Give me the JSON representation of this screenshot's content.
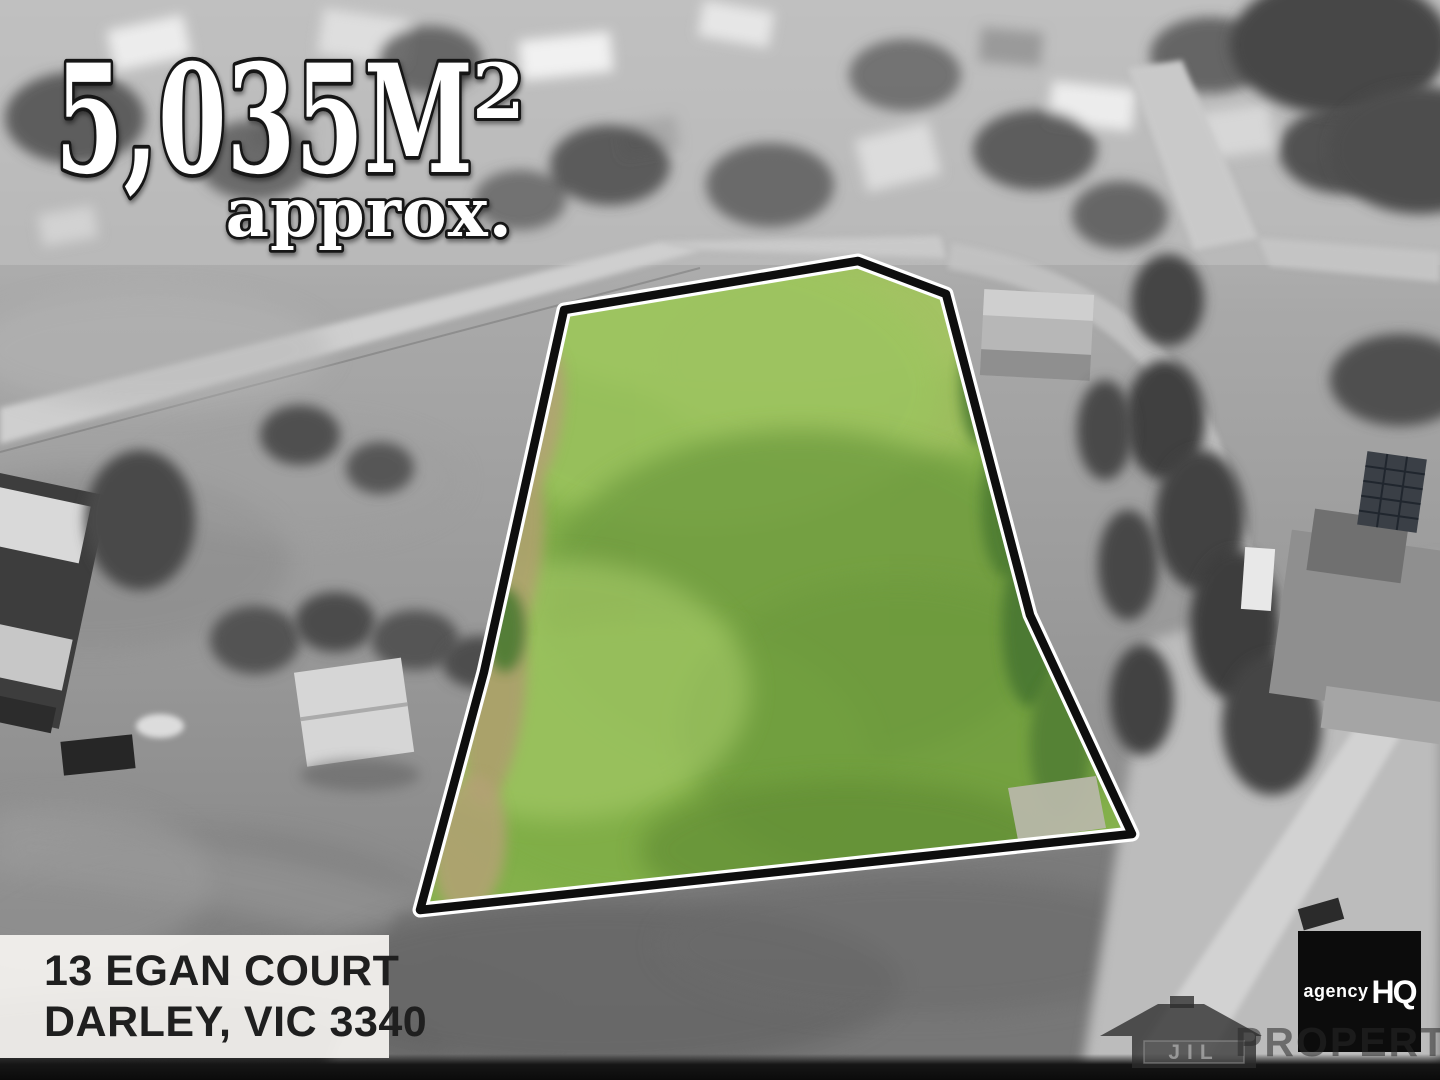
{
  "headline": {
    "area_value": "5,035M",
    "area_exponent": "2",
    "qualifier": "approx."
  },
  "address": {
    "line1": "13 EGAN COURT",
    "line2": "DARLEY, VIC 3340"
  },
  "branding": {
    "agency": {
      "name_word": "agency",
      "name_initials": "HQ",
      "badge_bg": "#0c0c0c",
      "badge_text": "#ffffff"
    },
    "watermark": {
      "initials": "JIL",
      "word": "PROPERTY"
    }
  },
  "parcel": {
    "fill": "#85b14c",
    "outline": "#0e0e0e",
    "halo": "#ffffff"
  }
}
